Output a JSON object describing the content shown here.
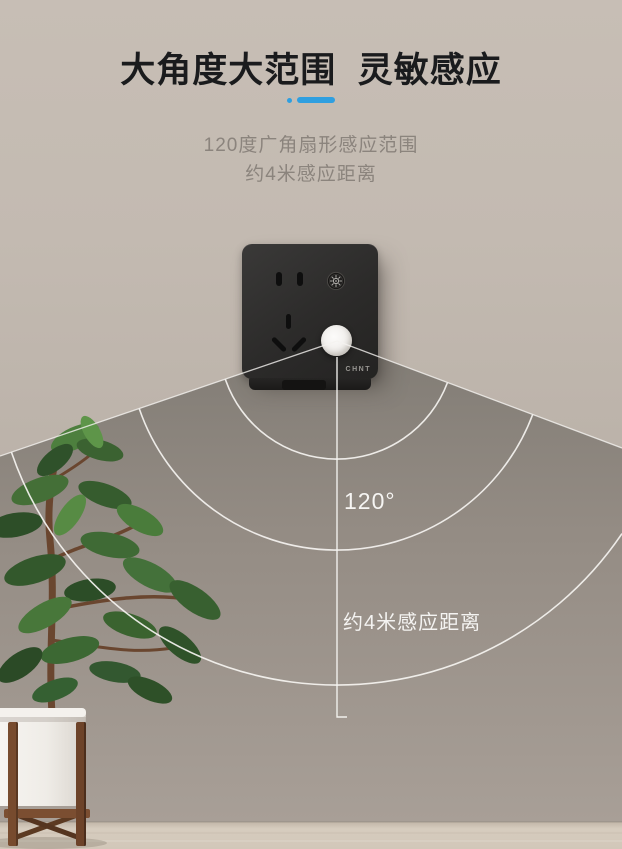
{
  "header": {
    "title": "大角度大范围  灵敏感应",
    "subtitle_line1": "120度广角扇形感应范围",
    "subtitle_line2": "约4米感应距离",
    "accent_color": "#2f9fe0"
  },
  "diagram": {
    "angle_label": "120°",
    "distance_label": "约4米感应距离",
    "sensing_angle_deg": 120,
    "sensing_distance_m": 4,
    "arc_count": 3
  },
  "product": {
    "brand": "CHNT",
    "icons": {
      "light_sensor_icon": "sun-rays",
      "motion_sensor_dome": "white-dome"
    }
  },
  "colors": {
    "accent_blue": "#2f9fe0",
    "title_text": "#1a1b1d",
    "subtitle_text": "#8b847d",
    "wall_top": "#c6bdb4",
    "wall_bottom": "#a9a098",
    "fan_top": "#817c75",
    "fan_bottom": "#a89f97",
    "floor": "#d5cabc",
    "socket_body": "#2d2c2b",
    "sensor_dome": "#f1efec",
    "leaf_green": "#3c6433",
    "label_text": "#f5f4f2"
  }
}
